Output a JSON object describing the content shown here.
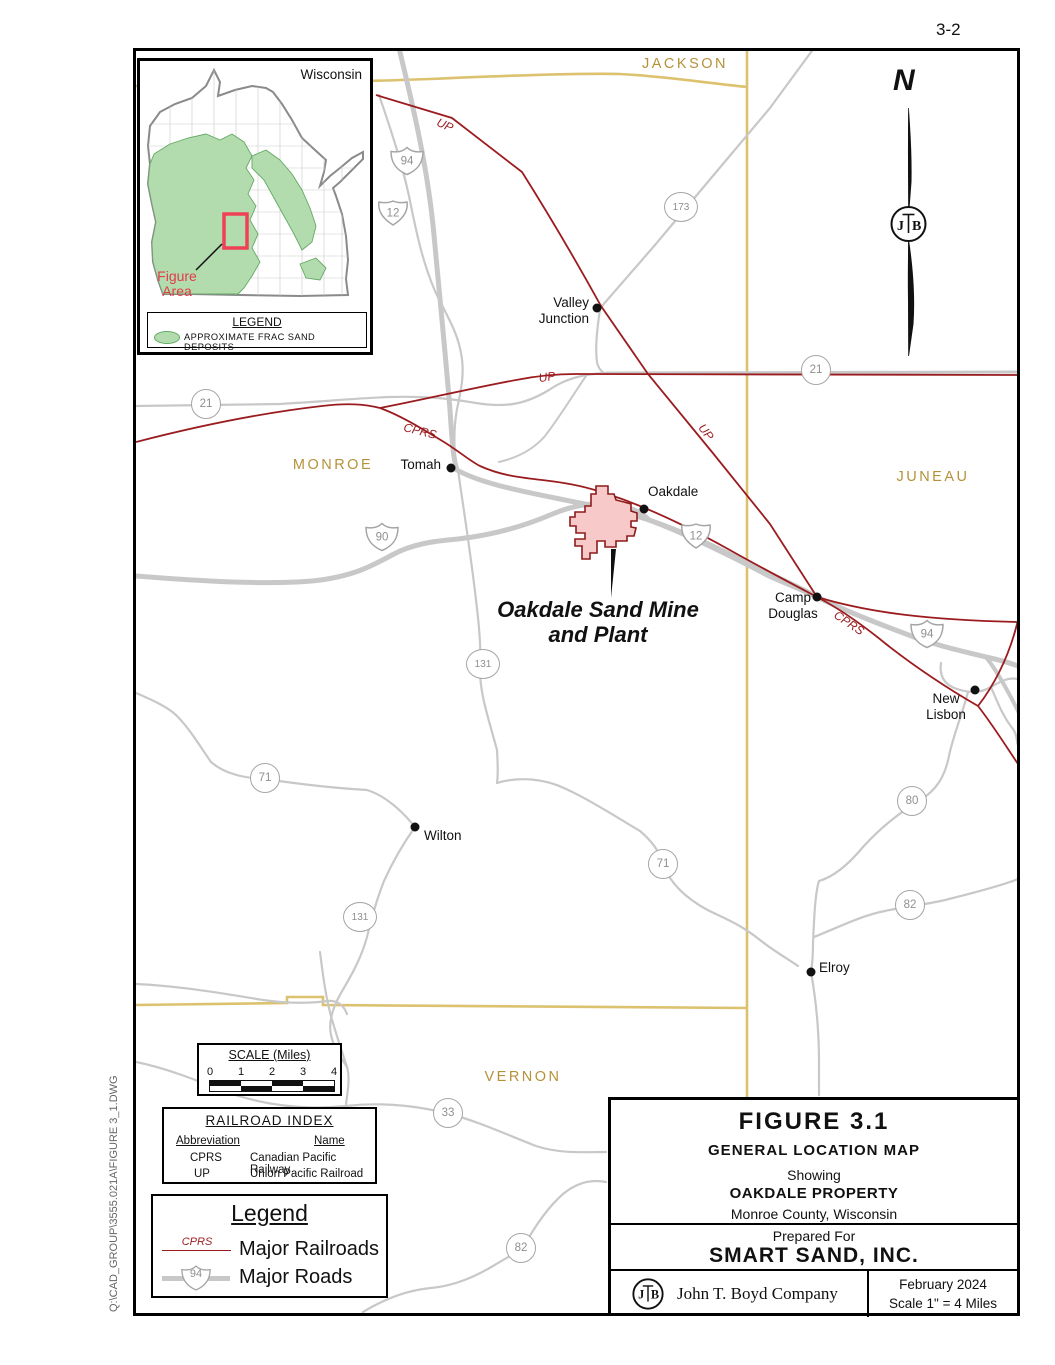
{
  "page": {
    "number": "3-2",
    "file_path": "Q:\\CAD_GROUP\\3555.021A\\FIGURE  3_1.DWG"
  },
  "north_arrow": {
    "label": "N"
  },
  "logo": {
    "left": "J",
    "right": "B"
  },
  "inset": {
    "state_label": "Wisconsin",
    "figure_area_line1": "Figure",
    "figure_area_line2": "Area",
    "legend_title": "LEGEND",
    "legend_item": "APPROXIMATE  FRAC  SAND  DEPOSITS",
    "deposit_color": "#b3dcae"
  },
  "map": {
    "county_color": "#b5923a",
    "county_line_color": "#dcc26e",
    "railroad_color": "#9b1c1f",
    "road_color": "#c8c8c8",
    "county_labels": [
      {
        "text": "JACKSON",
        "x": 685,
        "y": 64
      },
      {
        "text": "MONROE",
        "x": 333,
        "y": 465
      },
      {
        "text": "JUNEAU",
        "x": 933,
        "y": 477
      },
      {
        "text": "VERNON",
        "x": 523,
        "y": 1077
      }
    ],
    "cities": [
      {
        "name": "Valley Junction",
        "dot": [
          597,
          308
        ],
        "lines": [
          "Valley",
          "Junction"
        ],
        "lx": 489,
        "ly": 295,
        "w": 100,
        "align": "right"
      },
      {
        "name": "Tomah",
        "dot": [
          451,
          468
        ],
        "lines": [
          "Tomah"
        ],
        "lx": 341,
        "ly": 457,
        "w": 100,
        "align": "right"
      },
      {
        "name": "Oakdale",
        "dot": [
          644,
          509
        ],
        "lines": [
          "Oakdale"
        ],
        "lx": 648,
        "ly": 484,
        "w": 100,
        "align": "left"
      },
      {
        "name": "Camp Douglas",
        "dot": [
          817,
          597
        ],
        "lines": [
          "Camp",
          "Douglas"
        ],
        "lx": 743,
        "ly": 590,
        "w": 100,
        "align": "center"
      },
      {
        "name": "New Lisbon",
        "dot": [
          975,
          690
        ],
        "lines": [
          "New",
          "Lisbon"
        ],
        "lx": 896,
        "ly": 691,
        "w": 100,
        "align": "center"
      },
      {
        "name": "Wilton",
        "dot": [
          415,
          827
        ],
        "lines": [
          "Wilton"
        ],
        "lx": 424,
        "ly": 828,
        "w": 100,
        "align": "left"
      },
      {
        "name": "Elroy",
        "dot": [
          811,
          972
        ],
        "lines": [
          "Elroy"
        ],
        "lx": 819,
        "ly": 960,
        "w": 100,
        "align": "left"
      }
    ],
    "rail_labels": [
      {
        "text": "UP",
        "x": 445,
        "y": 125,
        "rot": 24
      },
      {
        "text": "UP",
        "x": 547,
        "y": 377,
        "rot": -8
      },
      {
        "text": "UP",
        "x": 706,
        "y": 432,
        "rot": 52
      },
      {
        "text": "CPRS",
        "x": 420,
        "y": 431,
        "rot": 14
      },
      {
        "text": "CPRS",
        "x": 849,
        "y": 623,
        "rot": 34
      }
    ],
    "shields": [
      {
        "type": "interstate",
        "num": "94",
        "x": 407,
        "y": 161
      },
      {
        "type": "us",
        "num": "12",
        "x": 393,
        "y": 213
      },
      {
        "type": "state",
        "num": "173",
        "x": 681,
        "y": 207,
        "wide": true
      },
      {
        "type": "state",
        "num": "21",
        "x": 206,
        "y": 404
      },
      {
        "type": "state",
        "num": "21",
        "x": 816,
        "y": 370
      },
      {
        "type": "interstate",
        "num": "90",
        "x": 382,
        "y": 537
      },
      {
        "type": "us",
        "num": "12",
        "x": 696,
        "y": 536
      },
      {
        "type": "state",
        "num": "131",
        "x": 483,
        "y": 664,
        "wide": true
      },
      {
        "type": "state",
        "num": "71",
        "x": 265,
        "y": 778
      },
      {
        "type": "state",
        "num": "71",
        "x": 663,
        "y": 864
      },
      {
        "type": "interstate",
        "num": "94",
        "x": 927,
        "y": 634
      },
      {
        "type": "state",
        "num": "80",
        "x": 912,
        "y": 801
      },
      {
        "type": "state",
        "num": "82",
        "x": 910,
        "y": 905
      },
      {
        "type": "state",
        "num": "131",
        "x": 360,
        "y": 917,
        "wide": true
      },
      {
        "type": "state",
        "num": "33",
        "x": 448,
        "y": 1113
      },
      {
        "type": "state",
        "num": "82",
        "x": 521,
        "y": 1248
      }
    ]
  },
  "mine": {
    "label_line1": "Oakdale Sand Mine",
    "label_line2": "and Plant",
    "fill": "#f7c9c9",
    "outline": "#8e1b1b"
  },
  "scale_bar": {
    "title": "SCALE (Miles)",
    "ticks": [
      "0",
      "1",
      "2",
      "3",
      "4"
    ]
  },
  "railroad_index": {
    "title": "RAILROAD  INDEX",
    "col_abb句reviation": "",
    "col1": "Abbreviation",
    "col2": "Name",
    "rows": [
      {
        "abbr": "CPRS",
        "name": "Canadian  Pacific  Railway"
      },
      {
        "abbr": "UP",
        "name": "Union  Pacific  Railroad"
      }
    ]
  },
  "legend": {
    "title": "Legend",
    "rail_tag": "CPRS",
    "railroads_label": "Major  Railroads",
    "roads_label": "Major  Roads",
    "road_shield": "94"
  },
  "title_block": {
    "figure": "FIGURE  3.1",
    "map_title": "GENERAL  LOCATION  MAP",
    "showing": "Showing",
    "property": "OAKDALE  PROPERTY",
    "county": "Monroe County, Wisconsin",
    "prepared_for": "Prepared  For",
    "client": "SMART  SAND,  INC.",
    "company": "John T. Boyd Company",
    "date": "February  2024",
    "scale": "Scale 1\" =  4 Miles"
  }
}
